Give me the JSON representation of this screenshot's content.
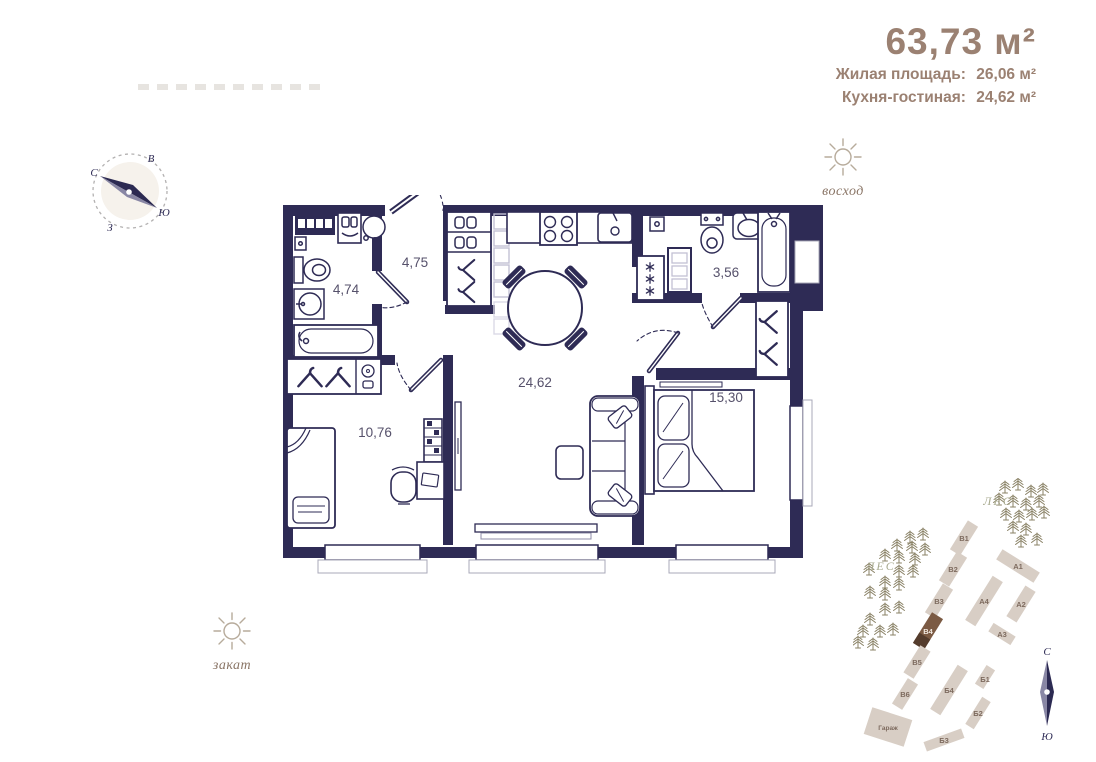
{
  "header": {
    "total_area": "63,73 м²",
    "rows": [
      {
        "label": "Жилая площадь:",
        "value": "26,06 м²"
      },
      {
        "label": "Кухня-гостиная:",
        "value": "24,62 м²"
      }
    ]
  },
  "compass": {
    "north": "С",
    "east": "В",
    "south": "Ю",
    "west": "З"
  },
  "sun": {
    "sunrise_label": "восход",
    "sunset_label": "закат"
  },
  "floorplan": {
    "rooms": [
      {
        "name": "bathroom-main",
        "area": "4,74"
      },
      {
        "name": "hallway",
        "area": "4,75"
      },
      {
        "name": "kitchen-living",
        "area": "24,62"
      },
      {
        "name": "bathroom-second",
        "area": "3,56"
      },
      {
        "name": "bedroom-small",
        "area": "10,76"
      },
      {
        "name": "bedroom-master",
        "area": "15,30"
      }
    ]
  },
  "siteplan": {
    "forest_label": "ЛЕС",
    "compass": {
      "north": "С",
      "south": "Ю"
    },
    "buildings": [
      {
        "label": "В1"
      },
      {
        "label": "В2"
      },
      {
        "label": "В3"
      },
      {
        "label": "В4",
        "highlighted": true
      },
      {
        "label": "В5"
      },
      {
        "label": "В6"
      },
      {
        "label": "Б1"
      },
      {
        "label": "Б2"
      },
      {
        "label": "Б3"
      },
      {
        "label": "Б4"
      },
      {
        "label": "А1"
      },
      {
        "label": "А2"
      },
      {
        "label": "А3"
      },
      {
        "label": "А4"
      },
      {
        "label": "Гараж"
      }
    ]
  },
  "colors": {
    "wall": "#2e2b55",
    "accent_text": "#9b8172",
    "building_fill": "#d8cec5",
    "building_highlight": "#7b5a43",
    "forest": "#a9ab90"
  },
  "icons": {
    "fridge": "snowflake-icon",
    "wardrobes": "hanger-icon",
    "forest": "pine-tree-icon",
    "orientation": "compass-icon",
    "daylight": "sun-icon"
  }
}
